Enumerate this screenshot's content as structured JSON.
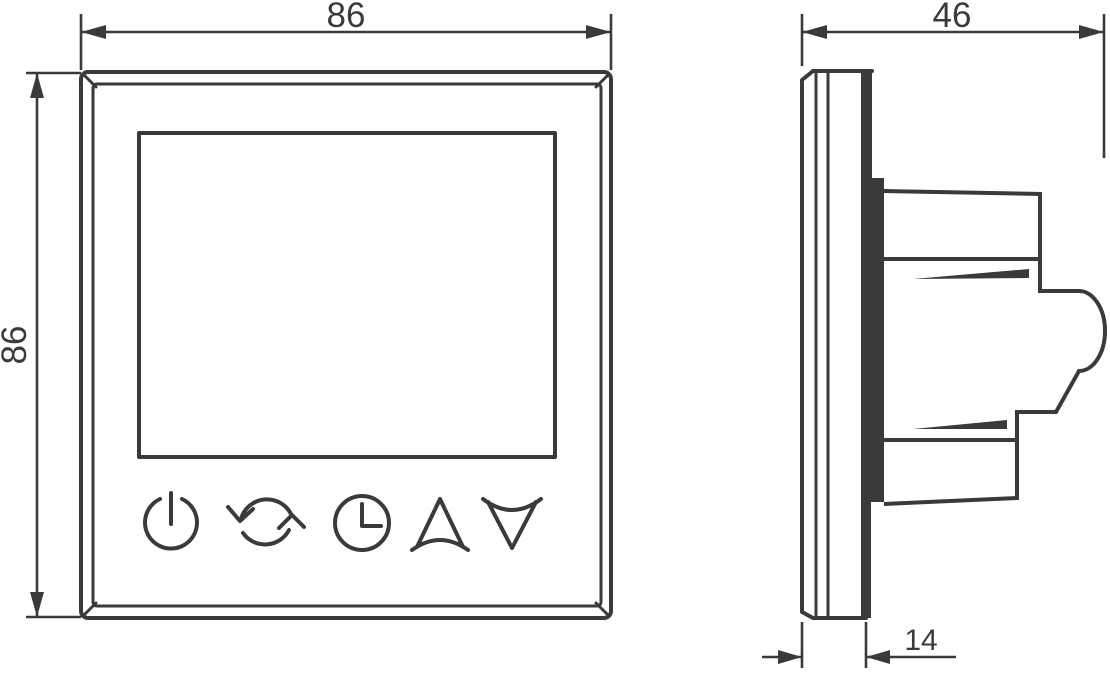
{
  "front_view": {
    "width_label": "86",
    "height_label": "86",
    "button_icons": [
      {
        "name": "power-icon"
      },
      {
        "name": "cycle-icon"
      },
      {
        "name": "clock-icon"
      },
      {
        "name": "up-arrow-icon"
      },
      {
        "name": "down-arrow-icon"
      }
    ]
  },
  "side_view": {
    "depth_label": "46",
    "panel_thickness_label": "14"
  },
  "colors": {
    "line": "#3a3a3c",
    "background": "#ffffff"
  }
}
